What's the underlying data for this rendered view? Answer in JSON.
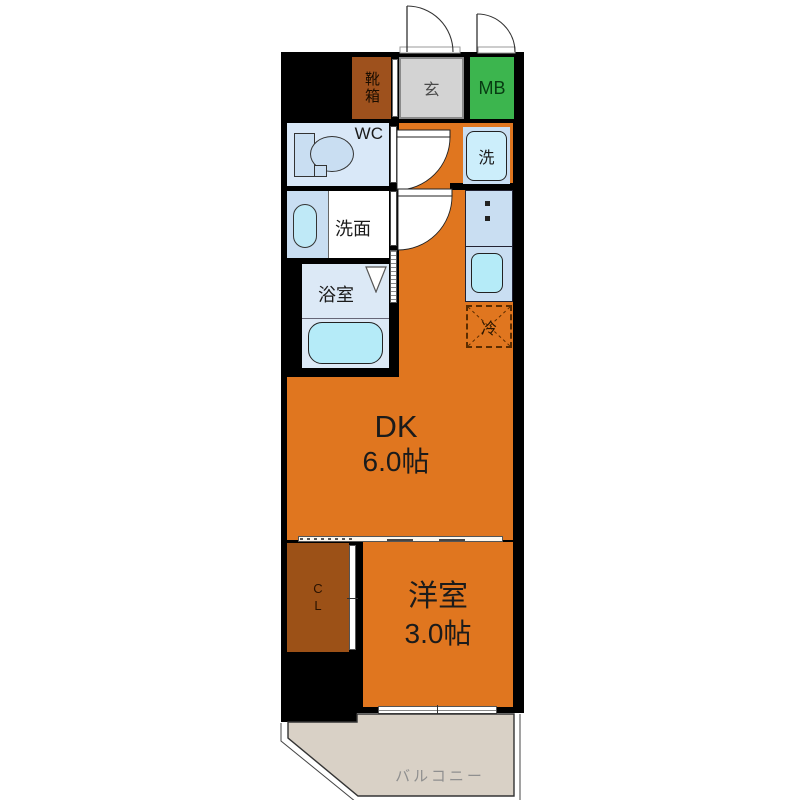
{
  "plan": {
    "rooms": {
      "shoe_box": {
        "label": "靴箱"
      },
      "entrance": {
        "label": "玄"
      },
      "meter_box": {
        "label": "MB"
      },
      "toilet": {
        "label": "WC"
      },
      "washer": {
        "label": "洗"
      },
      "washroom": {
        "label": "洗面"
      },
      "bathroom": {
        "label": "浴室"
      },
      "fridge": {
        "label": "冷"
      },
      "dining_kitchen": {
        "label": "DK",
        "size": "6.0帖"
      },
      "closet": {
        "label_lines": [
          "C",
          "L"
        ]
      },
      "western_room": {
        "label": "洋室",
        "size": "3.0帖"
      },
      "balcony": {
        "label": "バルコニー"
      }
    },
    "colors": {
      "wall": "#000000",
      "room_orange": "#e0761f",
      "shoe_box_brown": "#9e511d",
      "closet_brown": "#9c5117",
      "mb_green": "#3cb54e",
      "entrance_gray": "#d3d3d3",
      "fixture_blue": "#c9def2",
      "fixture_cyan": "#b5ebf8",
      "wc_room_blue": "#d9e8f8",
      "bath_blue": "#dce9f6",
      "balcony_beige": "#d9d1c6",
      "balcony_text": "#8f8f8f"
    }
  }
}
